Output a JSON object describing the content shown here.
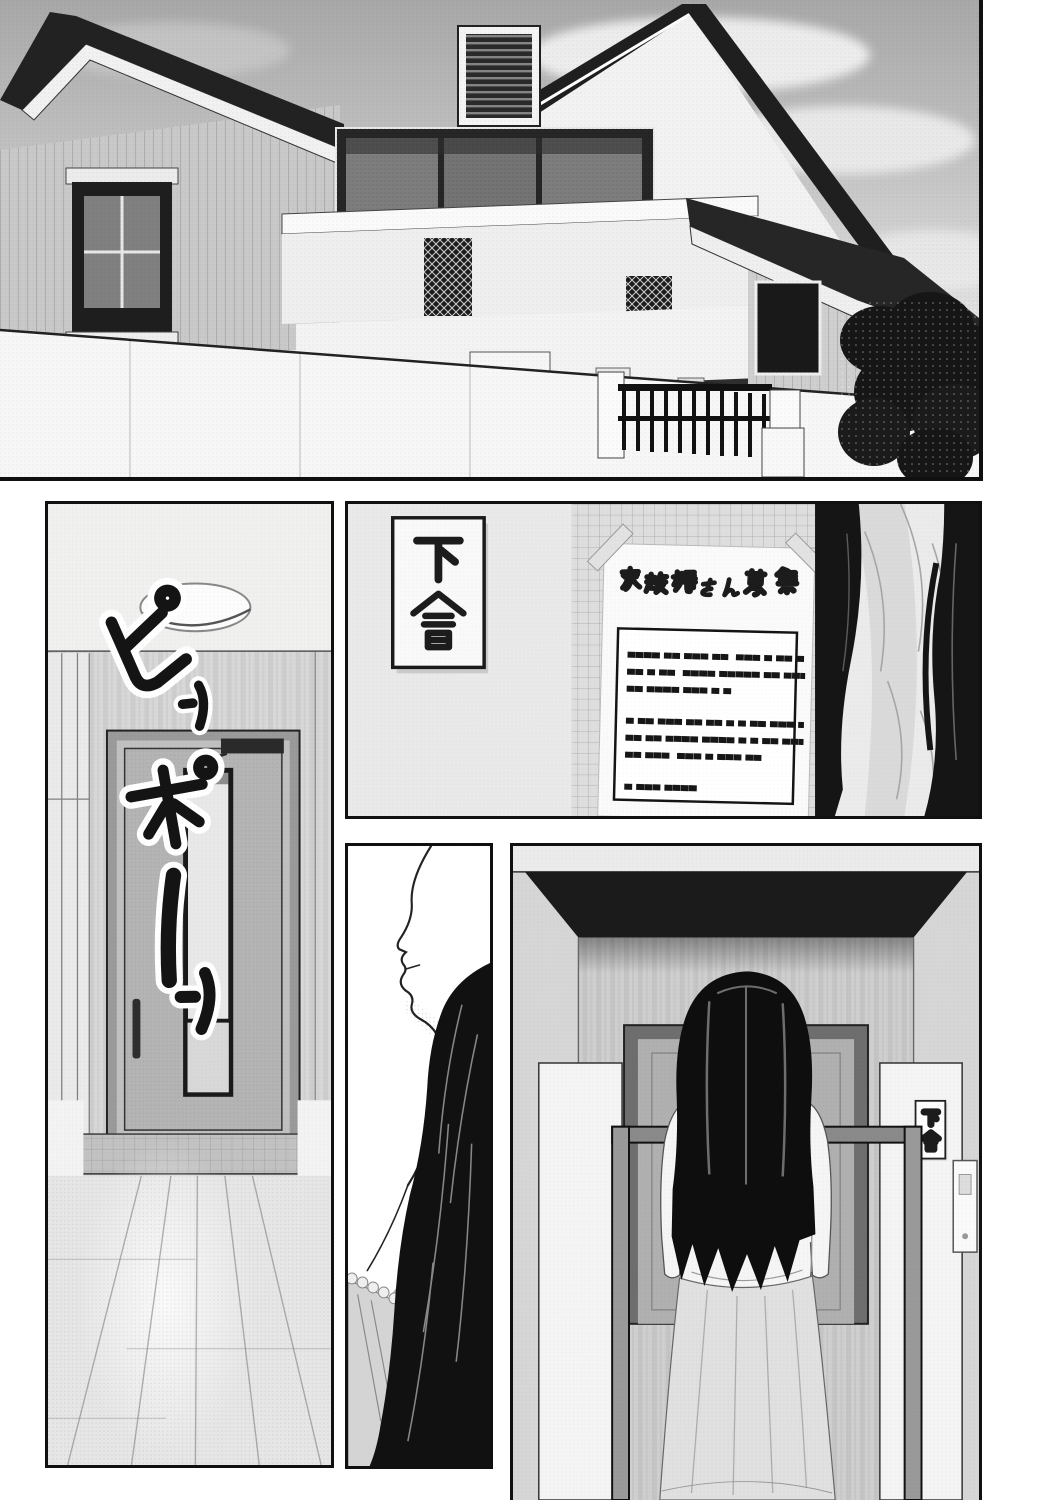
{
  "page": {
    "kind": "manga page (grayscale, right-to-left)",
    "background": "#ffffff",
    "ink": "#111111"
  },
  "sfx": {
    "text": "ピンポーン",
    "meaning": "ding-dong (doorbell)",
    "chars": [
      "ピ",
      "ン",
      "ポ",
      "ー",
      "ン"
    ]
  },
  "nameplate_wall": {
    "text": "下倉"
  },
  "nameplate_gate": {
    "text": "下倉"
  },
  "poster": {
    "title": "家政婦さん募集",
    "body_lines": [
      "▄▄▄▄ ▄▄ ▄▄▄ ▄▄  ▄▄▄ ▄ ▄▄ ▄ ▄▄▄ ▄ ▄",
      "▄▄ ▄ ▄▄  ▄▄▄▄ ▄▄▄▄▄ ▄▄ ▄▄▄",
      "▄▄ ▄▄▄▄ ▄▄▄ ▄ ▄",
      "",
      "▄ ▄▄ ▄▄▄ ▄▄ ▄▄ ▄ ▄ ▄▄ ▄▄▄ ▄▄▄▄",
      "▄▄ ▄▄ ▄▄▄▄ ▄▄▄▄ ▄ ▄ ▄▄ ▄▄▄",
      "▄▄ ▄▄▄  ▄▄▄ ▄ ▄▄▄ ▄▄",
      "",
      "▄ ▄▄▄ ▄▄▄▄"
    ]
  },
  "panels": [
    {
      "id": "house-exterior",
      "desc": "Two-story house with gabled roof, balcony and front wall under a cloudy sky; trees at right"
    },
    {
      "id": "entryway",
      "desc": "Interior entry hall with front door and wooden floor while the doorbell rings"
    },
    {
      "id": "gate-wall",
      "desc": "Gate wall with Shimokura nameplate and a housekeeper-wanted notice; long-haired woman at right"
    },
    {
      "id": "face-closeup",
      "desc": "Profile close-up of a woman with long black hair"
    },
    {
      "id": "front-gate",
      "desc": "Woman seen from behind standing at the front gate facing the door"
    }
  ],
  "colors": {
    "sky": "#c6c6c6",
    "hair": "#0e0e0e",
    "wall": "#e4e4e4",
    "door": "#b4b4b4",
    "skirt": "#e0e0e0",
    "ink": "#111111"
  }
}
